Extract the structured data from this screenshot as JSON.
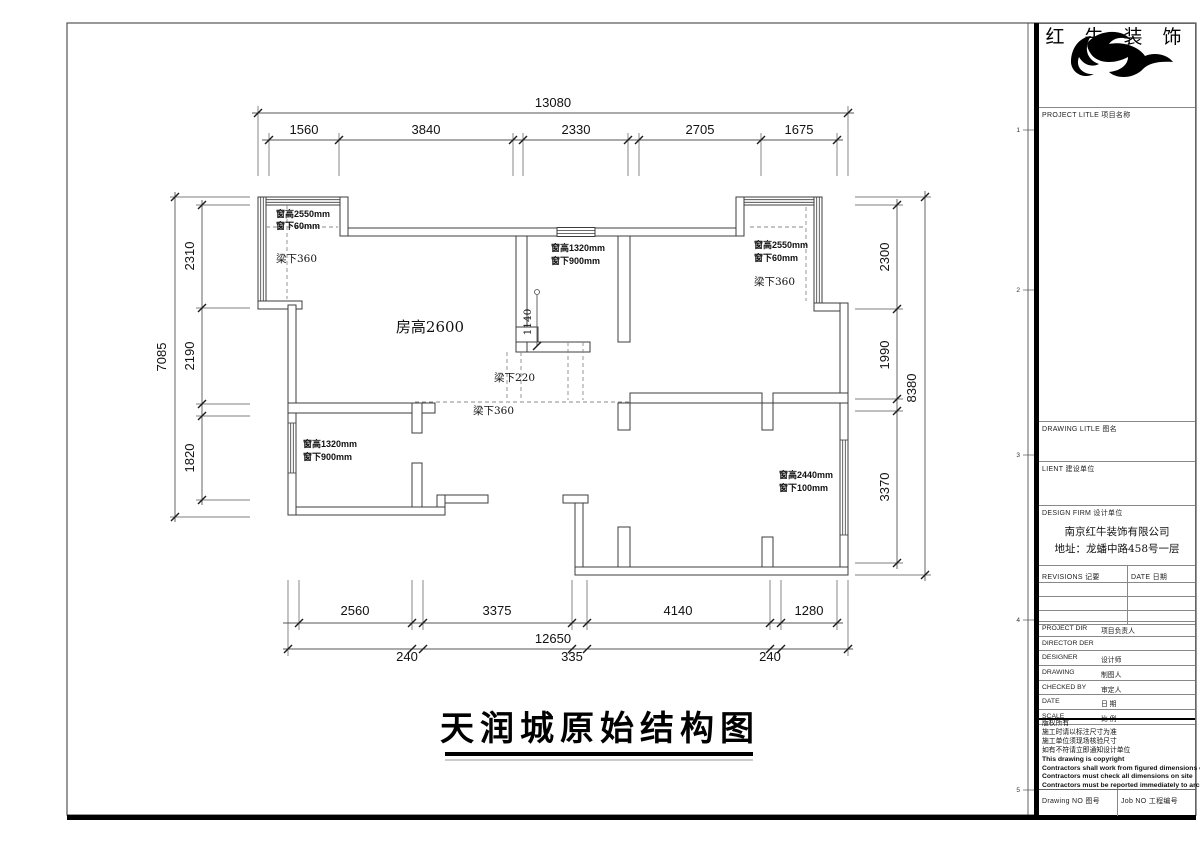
{
  "titleblock": {
    "brand": "红 牛 装 饰",
    "project_label": "PROJECT LITLE  项目名称",
    "drawing_label": "DRAWING LITLE  图名",
    "client_label": "LIENT  建设单位",
    "firm_label": "DESIGN FIRM  设计单位",
    "company": "南京红牛装饰有限公司",
    "address": "地址：龙蟠中路458号一层",
    "revisions_label": "REVISIONS  记要",
    "date_col_label": "DATE  日期",
    "rows": [
      {
        "en": "PROJECT DIR",
        "zh": "项目负责人"
      },
      {
        "en": "DIRECTOR DER",
        "zh": ""
      },
      {
        "en": "DESIGNER",
        "zh": "设计师"
      },
      {
        "en": "DRAWING",
        "zh": "制图人"
      },
      {
        "en": "CHECKED BY",
        "zh": "审定人"
      },
      {
        "en": "DATE",
        "zh": "日  期"
      },
      {
        "en": "SCALE",
        "zh": "比  例"
      }
    ],
    "notes_zh": [
      "版权所有",
      "施工时请以标注尺寸为准",
      "施工单位须现场核验尺寸",
      "如有不符请立即通知设计单位"
    ],
    "notes_en": [
      "This drawing is copyright",
      "Contractors shall work from figured dimensions only",
      "Contractors must check all dimensions on site",
      "Contractors must be reported immediately to architects"
    ],
    "drawing_no_label": "Drawing NO  图号",
    "job_no_label": "Job NO  工程编号"
  },
  "plan": {
    "title": "天润城原始结构图",
    "room_height": "房高2600",
    "labels": {
      "win_tl_1": "窗高2550mm",
      "win_tl_2": "窗下60mm",
      "beam_tl": "梁下360",
      "win_tm_1": "窗高1320mm",
      "win_tm_2": "窗下900mm",
      "win_tr_1": "窗高2550mm",
      "win_tr_2": "窗下60mm",
      "beam_tr": "梁下360",
      "beam_mid": "梁下220",
      "beam_mid2": "梁下360",
      "win_bl_1": "窗高1320mm",
      "win_bl_2": "窗下900mm",
      "win_br_1": "窗高2440mm",
      "win_br_2": "窗下100mm",
      "dim_1140": "1140"
    },
    "dims": {
      "top_overall": "13080",
      "top": [
        "1560",
        "3840",
        "2330",
        "2705",
        "1675"
      ],
      "left_overall": "7085",
      "left": [
        "2310",
        "2190",
        "1820"
      ],
      "right_overall": "8380",
      "right": [
        "2300",
        "1990",
        "3370"
      ],
      "bottom": [
        "2560",
        "3375",
        "4140",
        "1280"
      ],
      "bottom_overall": "12650",
      "bottom_extra": [
        "240",
        "335",
        "240"
      ]
    }
  },
  "ruler_marks": [
    "1",
    "2",
    "3",
    "4",
    "5"
  ]
}
